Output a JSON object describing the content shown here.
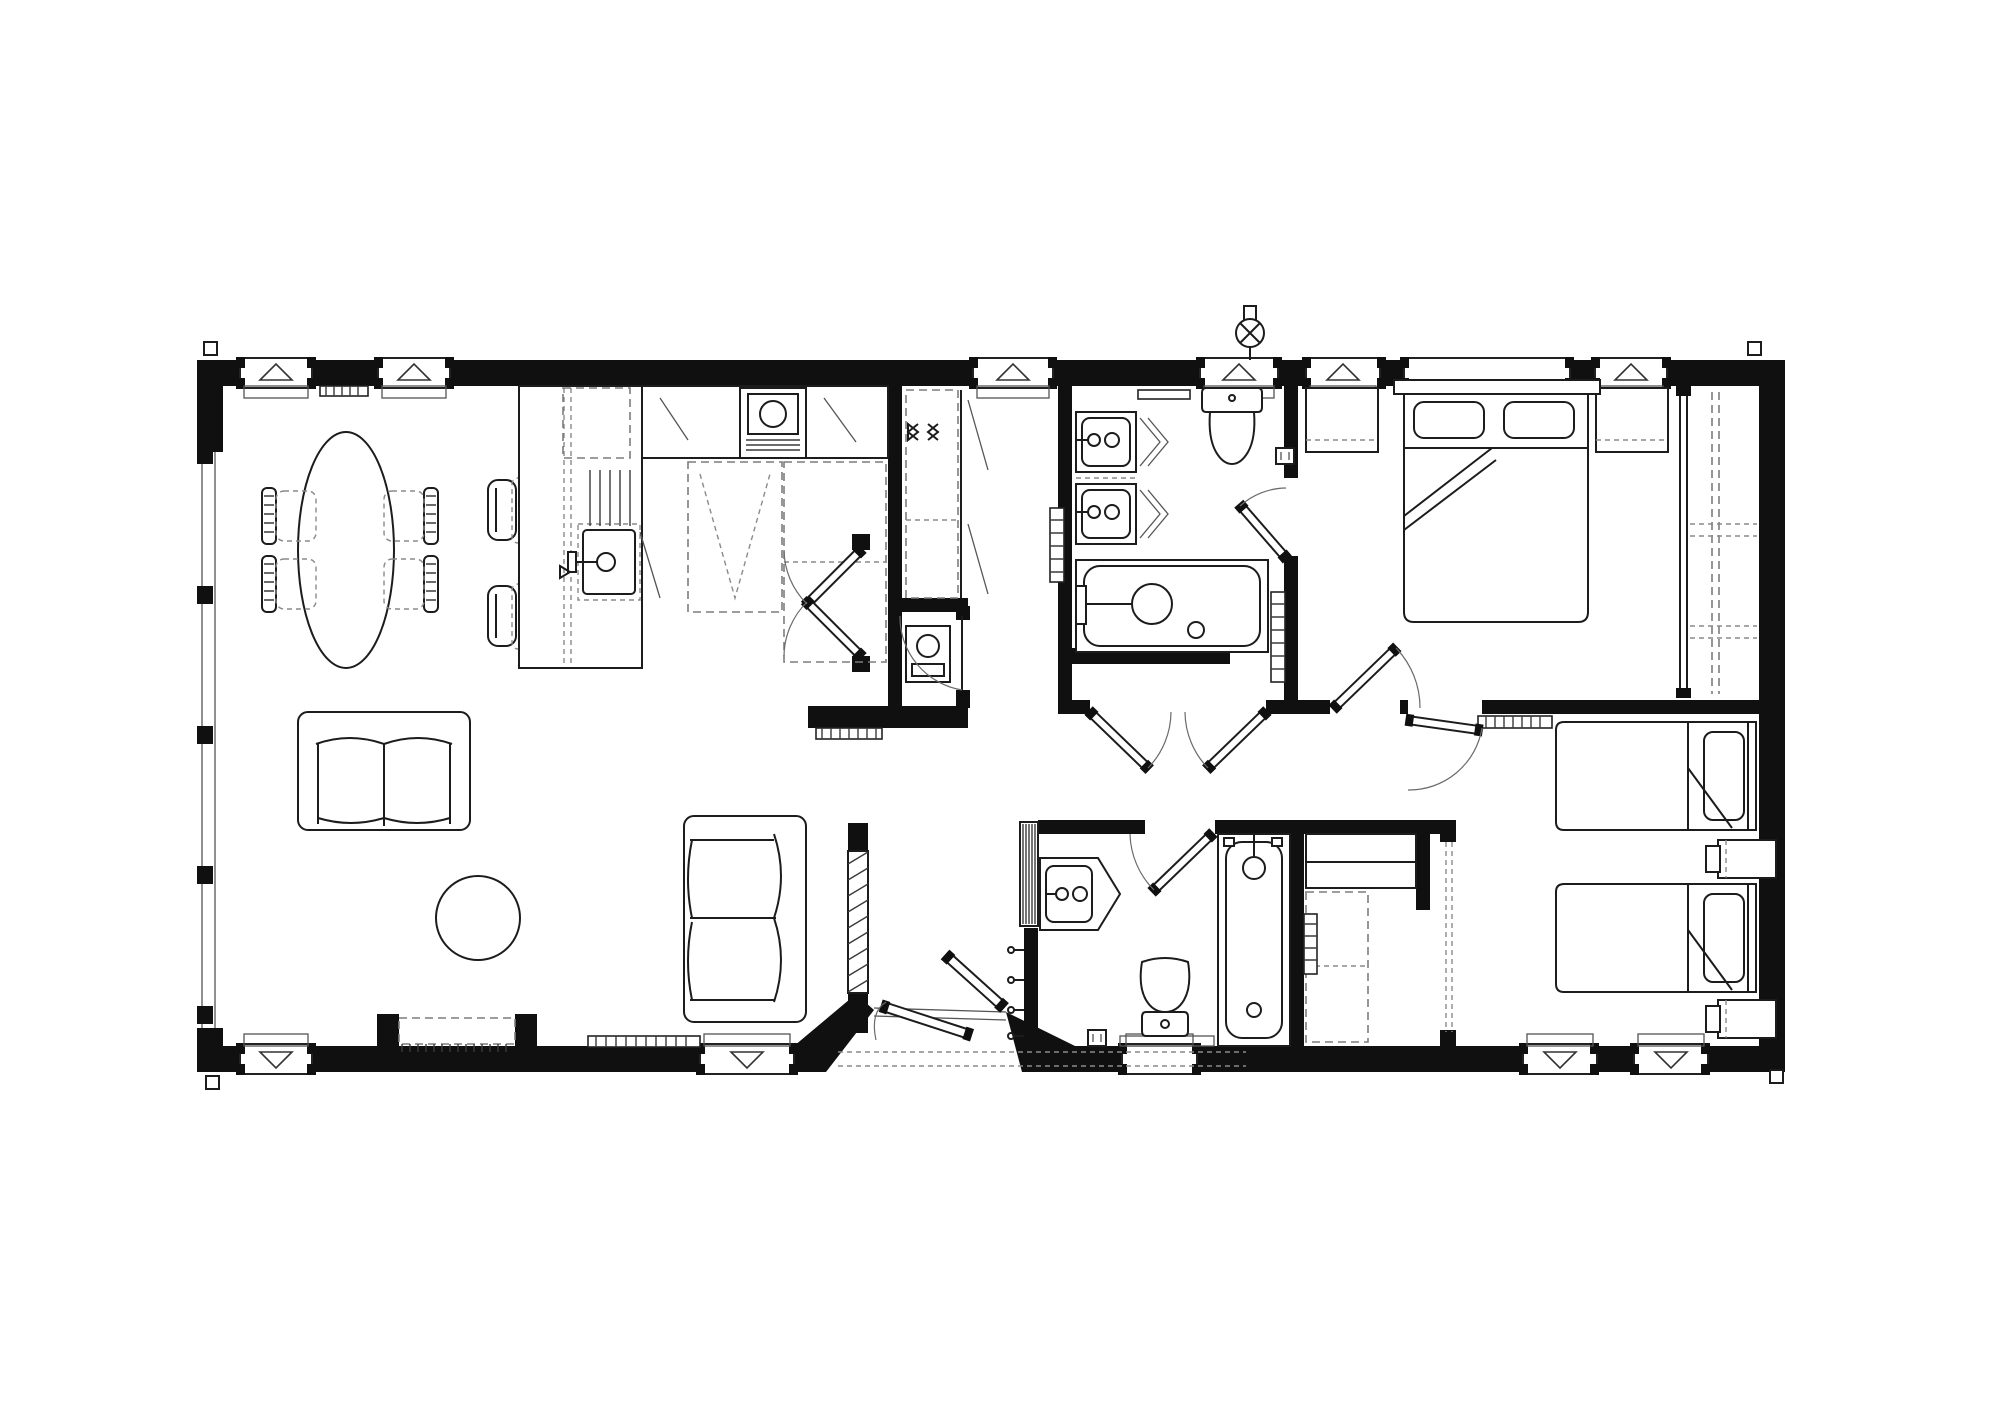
{
  "document": {
    "kind": "architectural-floor-plan",
    "style": "monochrome 2D CAD drawing, plan view",
    "building_type": "two-bedroom lodge / park home",
    "visible_text": "none"
  },
  "palette": {
    "background": "#ffffff",
    "wall_color": "#101010",
    "furniture_line": "#1c1c1c",
    "detail_line": "#555555",
    "dashed_line": "#7d7d7d"
  },
  "rooms": [
    {
      "name": "open-plan-living-dining-kitchen",
      "position": "left half",
      "items": [
        "oval dining table",
        "four dining chairs",
        "breakfast-bar island with sink and tap",
        "two bar stools",
        "kitchen run with cooker-oven",
        "overhead cabinets (dashed)",
        "tall appliance spaces (dashed)",
        "two-seat sofa (north)",
        "two-seat sofa (east)",
        "round coffee table",
        "media / fireplace recess in south wall",
        "radiators",
        "full-height glazing on west wall"
      ]
    },
    {
      "name": "hallway",
      "position": "centre",
      "items": [
        "sliding-door closet with hanging rails",
        "airing cupboard with boiler",
        "double doors to living area",
        "coat hooks",
        "hatched feature partition at entrance",
        "glazed entrance French doors in angled recess",
        "decking edge (dashed) outside"
      ]
    },
    {
      "name": "family-bathroom",
      "position": "top centre-right",
      "items": [
        "twin wash basins",
        "WC with cistern",
        "bath with shower mixer",
        "ladder towel radiators",
        "towel rail",
        "shaver socket",
        "external wall light",
        "double doors from hallway",
        "door to master bedroom"
      ]
    },
    {
      "name": "master-bedroom",
      "position": "top right",
      "items": [
        "double bed with two pillows",
        "two bedside tables",
        "full-height sliding-door wardrobe with shelving (dashed)",
        "three windows"
      ]
    },
    {
      "name": "shower-room",
      "position": "bottom centre-right",
      "items": [
        "vanity basin",
        "WC",
        "second bath with shower",
        "shower screen (striped)",
        "obscure window"
      ]
    },
    {
      "name": "twin-bedroom",
      "position": "bottom right",
      "items": [
        "two single beds with pillows",
        "two bedside cabinets",
        "radiator",
        "built-in storage with shelving (dashed)",
        "sliding door (dashed)",
        "two windows"
      ]
    }
  ],
  "openings": {
    "windows_top": 6,
    "windows_bottom": 5,
    "west_glazing": "full-height glazed wall with mullions",
    "vent_triangle_note": "hollow triangles point outwards on opening windows",
    "entrance": "angled recessed doorway with pair of part-open French doors"
  },
  "symbols": [
    "triangle-window-vent",
    "downpipe-square-at-corners",
    "wall-light-circle-cross",
    "door-swing-arc",
    "hanging-rail-cross",
    "shaver-socket"
  ]
}
